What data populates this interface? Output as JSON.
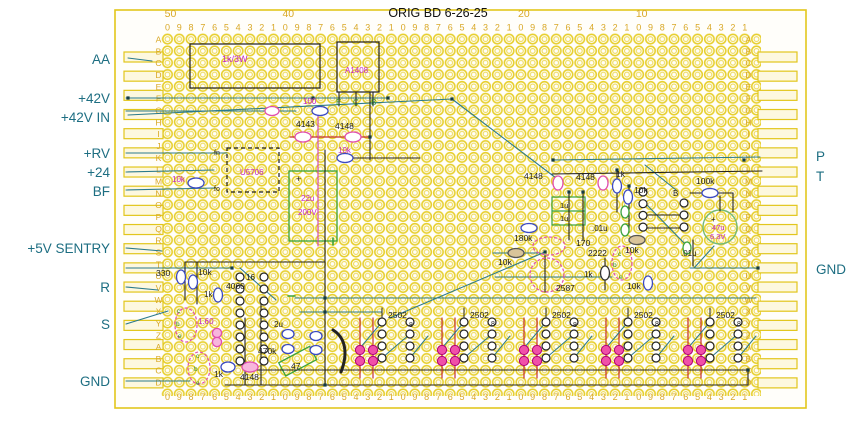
{
  "title": "ORIG BD  6-26-25",
  "colors": {
    "board_yellow": "#e2c61c",
    "scale_gold": "#d9a827",
    "label_teal": "#1d6e82",
    "text_magenta": "#c226c2",
    "text_black": "#1c1c1c",
    "text_green": "#2e8b2e",
    "wire_teal": "#2b7a8c",
    "wire_red": "#c43030",
    "comp_blue": "#3a49c4",
    "comp_magenta": "#e04fb0",
    "comp_green": "#39a23c"
  },
  "board": {
    "column_numbers": [
      {
        "label": "50",
        "col": 0
      },
      {
        "label": "40",
        "col": 10
      },
      {
        "label": "20",
        "col": 30
      },
      {
        "label": "10",
        "col": 40
      }
    ],
    "digit_sequence": "0987654321",
    "digit_repeats": 5,
    "row_letters": "ABCDEFGHIJKLMNOPQRSTUVWXYZABCD"
  },
  "left_labels": [
    {
      "text": "AA",
      "y": 64
    },
    {
      "text": "+42V",
      "y": 103
    },
    {
      "text": "+42V IN",
      "y": 122
    },
    {
      "text": "+RV",
      "y": 158
    },
    {
      "text": "+24",
      "y": 177
    },
    {
      "text": "BF",
      "y": 196
    },
    {
      "text": "+5V SENTRY",
      "y": 253
    },
    {
      "text": "R",
      "y": 292
    },
    {
      "text": "S",
      "y": 329
    },
    {
      "text": "GND",
      "y": 386
    }
  ],
  "right_labels": [
    {
      "text": "P",
      "y": 161
    },
    {
      "text": "T",
      "y": 181
    },
    {
      "text": "GND",
      "y": 274
    }
  ],
  "component_texts": [
    {
      "t": "1k/3W",
      "x": 222,
      "y": 62,
      "c": "text_magenta",
      "s": 9
    },
    {
      "t": "A1408",
      "x": 345,
      "y": 73,
      "c": "text_magenta",
      "s": 8
    },
    {
      "t": "100",
      "x": 303,
      "y": 104,
      "c": "text_magenta",
      "s": 8
    },
    {
      "t": "E",
      "x": 336,
      "y": 105,
      "c": "text_green",
      "s": 8
    },
    {
      "t": "C",
      "x": 353,
      "y": 105,
      "c": "text_green",
      "s": 8
    },
    {
      "t": "B",
      "x": 371,
      "y": 105,
      "c": "text_green",
      "s": 8
    },
    {
      "t": "4143",
      "x": 296,
      "y": 127,
      "c": "text_black",
      "s": 8.5
    },
    {
      "t": "4148",
      "x": 335,
      "y": 129,
      "c": "text_black",
      "s": 8.5
    },
    {
      "t": "10k",
      "x": 338,
      "y": 153,
      "c": "text_magenta",
      "s": 8
    },
    {
      "t": "fn",
      "x": 214,
      "y": 155,
      "c": "text_black",
      "s": 7
    },
    {
      "t": "fo",
      "x": 214,
      "y": 191,
      "c": "text_black",
      "s": 7
    },
    {
      "t": "U5706",
      "x": 240,
      "y": 175,
      "c": "text_magenta",
      "s": 8
    },
    {
      "t": "10k",
      "x": 172,
      "y": 182,
      "c": "text_magenta",
      "s": 8
    },
    {
      "t": "+",
      "x": 296,
      "y": 182,
      "c": "text_black",
      "s": 9
    },
    {
      "t": "22u",
      "x": 301,
      "y": 201,
      "c": "text_magenta",
      "s": 8
    },
    {
      "t": "200V",
      "x": 298,
      "y": 215,
      "c": "text_magenta",
      "s": 8
    },
    {
      "t": "4148",
      "x": 524,
      "y": 179,
      "c": "text_black",
      "s": 8.5
    },
    {
      "t": "4148",
      "x": 576,
      "y": 180,
      "c": "text_black",
      "s": 8.5
    },
    {
      "t": "1k",
      "x": 616,
      "y": 177,
      "c": "text_black",
      "s": 8.5
    },
    {
      "t": "10k",
      "x": 634,
      "y": 193,
      "c": "text_black",
      "s": 8.5
    },
    {
      "t": "100k",
      "x": 696,
      "y": 184,
      "c": "text_black",
      "s": 8.5
    },
    {
      "t": "B",
      "x": 673,
      "y": 196,
      "c": "text_black",
      "s": 8
    },
    {
      "t": "1u",
      "x": 560,
      "y": 208,
      "c": "text_black",
      "s": 7.5
    },
    {
      "t": "1u",
      "x": 560,
      "y": 221,
      "c": "text_black",
      "s": 7.5
    },
    {
      "t": ".01u",
      "x": 592,
      "y": 231,
      "c": "text_black",
      "s": 8
    },
    {
      "t": "+",
      "x": 711,
      "y": 222,
      "c": "text_black",
      "s": 8
    },
    {
      "t": "47u",
      "x": 712,
      "y": 230,
      "c": "text_magenta",
      "s": 7.5
    },
    {
      "t": "6.3V",
      "x": 710,
      "y": 239,
      "c": "text_magenta",
      "s": 7.5
    },
    {
      "t": ".01u",
      "x": 681,
      "y": 256,
      "c": "text_black",
      "s": 8
    },
    {
      "t": "180k",
      "x": 514,
      "y": 241,
      "c": "text_black",
      "s": 8.5
    },
    {
      "t": "10k",
      "x": 498,
      "y": 265,
      "c": "text_black",
      "s": 8.5
    },
    {
      "t": "170",
      "x": 576,
      "y": 246,
      "c": "text_black",
      "s": 8.5
    },
    {
      "t": "2222",
      "x": 588,
      "y": 256,
      "c": "text_black",
      "s": 8.5
    },
    {
      "t": "c",
      "x": 618,
      "y": 256,
      "c": "text_green",
      "s": 6.5
    },
    {
      "t": "b",
      "x": 613,
      "y": 267,
      "c": "text_green",
      "s": 6.5
    },
    {
      "t": "e",
      "x": 619,
      "y": 279,
      "c": "text_green",
      "s": 6.5
    },
    {
      "t": "1k",
      "x": 584,
      "y": 277,
      "c": "text_black",
      "s": 8
    },
    {
      "t": "10k",
      "x": 625,
      "y": 253,
      "c": "text_black",
      "s": 8.5
    },
    {
      "t": "10k",
      "x": 627,
      "y": 289,
      "c": "text_black",
      "s": 8.5
    },
    {
      "t": "2587",
      "x": 556,
      "y": 291,
      "c": "text_black",
      "s": 8.5
    },
    {
      "t": "330",
      "x": 156,
      "y": 276,
      "c": "text_black",
      "s": 8.5
    },
    {
      "t": "10k",
      "x": 198,
      "y": 275,
      "c": "text_black",
      "s": 8.5
    },
    {
      "t": "1k",
      "x": 204,
      "y": 297,
      "c": "text_black",
      "s": 8
    },
    {
      "t": "16",
      "x": 246,
      "y": 280,
      "c": "text_black",
      "s": 8
    },
    {
      "t": "4060",
      "x": 226,
      "y": 289,
      "c": "text_black",
      "s": 8.5
    },
    {
      "t": "c",
      "x": 177,
      "y": 313,
      "c": "text_green",
      "s": 6.5
    },
    {
      "t": "b",
      "x": 176,
      "y": 326,
      "c": "text_green",
      "s": 6.5
    },
    {
      "t": "e",
      "x": 178,
      "y": 338,
      "c": "text_green",
      "s": 6.5
    },
    {
      "t": "1.60",
      "x": 198,
      "y": 324,
      "c": "text_magenta",
      "s": 8
    },
    {
      "t": "2u",
      "x": 274,
      "y": 327,
      "c": "text_black",
      "s": 8
    },
    {
      "t": "c",
      "x": 196,
      "y": 358,
      "c": "text_green",
      "s": 6.5
    },
    {
      "t": "b",
      "x": 194,
      "y": 371,
      "c": "text_green",
      "s": 6.5
    },
    {
      "t": "e",
      "x": 196,
      "y": 385,
      "c": "text_green",
      "s": 6.5
    },
    {
      "t": "470k",
      "x": 258,
      "y": 354,
      "c": "text_black",
      "s": 8.5
    },
    {
      "t": "47",
      "x": 291,
      "y": 369,
      "c": "text_black",
      "s": 8.5
    },
    {
      "t": "1k",
      "x": 214,
      "y": 377,
      "c": "text_black",
      "s": 8.5
    },
    {
      "t": "4148",
      "x": 240,
      "y": 380,
      "c": "text_black",
      "s": 8.5
    },
    {
      "t": "2502",
      "x": 388,
      "y": 318,
      "c": "text_black",
      "s": 8.5
    },
    {
      "t": "2502",
      "x": 470,
      "y": 318,
      "c": "text_black",
      "s": 8.5
    },
    {
      "t": "2502",
      "x": 552,
      "y": 318,
      "c": "text_black",
      "s": 8.5
    },
    {
      "t": "2502",
      "x": 634,
      "y": 318,
      "c": "text_black",
      "s": 8.5
    },
    {
      "t": "2502",
      "x": 716,
      "y": 318,
      "c": "text_black",
      "s": 8.5
    },
    {
      "t": "8",
      "x": 409,
      "y": 327,
      "c": "text_black",
      "s": 7
    },
    {
      "t": "8",
      "x": 491,
      "y": 326,
      "c": "text_black",
      "s": 7
    },
    {
      "t": "8",
      "x": 573,
      "y": 327,
      "c": "text_black",
      "s": 7
    },
    {
      "t": "8",
      "x": 655,
      "y": 326,
      "c": "text_black",
      "s": 7
    },
    {
      "t": "8",
      "x": 737,
      "y": 326,
      "c": "text_black",
      "s": 7
    }
  ]
}
